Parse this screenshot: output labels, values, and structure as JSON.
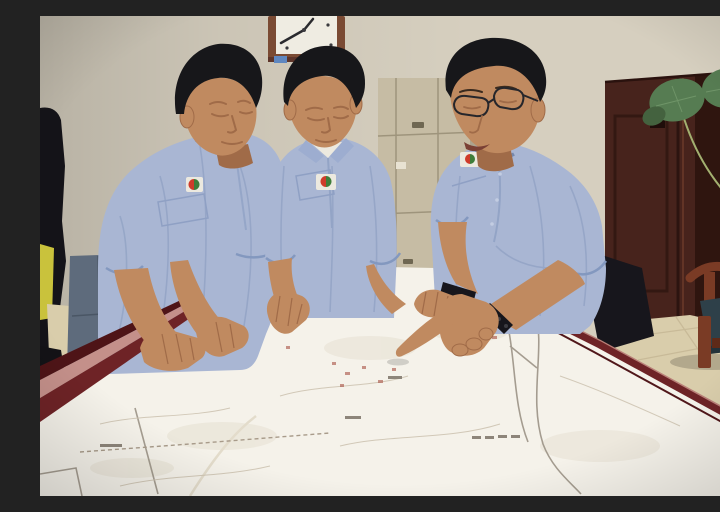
{
  "scene": {
    "type": "photograph",
    "setting": "Three workers in light blue uniform shirts lean over a large white engineering map spread on a dark-red meeting table; the man on the right wears glasses and points at the map",
    "people": [
      {
        "id": "left-worker",
        "description": "man with head bowed, leaning on the table with both hands",
        "wears": "light blue short-sleeve uniform shirt, jeans, chest logo badge"
      },
      {
        "id": "middle-worker",
        "description": "man with head bowed straight down studying the map, right hand pressed on the sheet",
        "wears": "light blue short-sleeve uniform shirt, white undershirt, chest logo badge"
      },
      {
        "id": "right-worker",
        "description": "man with glasses pointing at a map location with extended index finger, black watch and bead bracelet on wrists",
        "wears": "light blue short-sleeve uniform shirt, dark trousers, chest logo badge"
      }
    ],
    "objects": [
      {
        "id": "wall-clock",
        "description": "wood-framed wall clock, white face, dark hands, small blue tag below"
      },
      {
        "id": "file-cabinet",
        "description": "beige metal cabinet with small handles behind the workers"
      },
      {
        "id": "wooden-door",
        "description": "dark reddish-brown panelled door on the right"
      },
      {
        "id": "door-sign",
        "description": "dark vertical plaque with rows of tiny illegible white characters"
      },
      {
        "id": "potted-plant-leaves",
        "description": "large round green leaves on thin stems crossing the top-right corner"
      },
      {
        "id": "wooden-chair",
        "description": "wooden armchair with dark teal cushion on beige tiled floor"
      },
      {
        "id": "meeting-table",
        "description": "dark red table with maroon edge rail"
      },
      {
        "id": "map-sheet",
        "description": "large white map with faint contour patches, gray boundary polylines, scattered red marks and tiny illegible labels"
      },
      {
        "id": "bystander-silhouette",
        "description": "partial dark figure with a yellow vest at the far left edge"
      }
    ]
  },
  "colors": {
    "wall": "#d6cfbf",
    "clockFrame": "#7a4a33",
    "clockFace": "#efece2",
    "cabinet": "#c6bca4",
    "door": "#47231c",
    "doorDark": "#2f150f",
    "doorTrim": "#5d3425",
    "sign": "#232a36",
    "leaf": "#567c52",
    "leafDark": "#44623f",
    "stem": "#a3b070",
    "floor": "#d9cdab",
    "grout": "#c2b391",
    "chairWood": "#7a3b25",
    "cushion": "#2e4049",
    "bystander": "#141318",
    "vest": "#c9c23c",
    "jeans": "#5e6b7c",
    "trousers": "#17161c",
    "map": "#f5f2ea",
    "mapLine": "#978e81",
    "mapFaint": "#cec4b2",
    "mapRed": "#a85043",
    "tableDark": "#6e2326",
    "tableHi": "#c4908a",
    "tableDeep": "#4e1417",
    "shirt": "#a9b6d3",
    "shirtShadow": "#8b9cc0",
    "collarWhite": "#ece9df",
    "skin": "#c08a60",
    "skinShadow": "#a06b48",
    "hair": "#17171a",
    "glasses": "#26262b",
    "badgeRed": "#cf3b2a",
    "badgeGreen": "#3f7d3a",
    "watch": "#17161c"
  }
}
